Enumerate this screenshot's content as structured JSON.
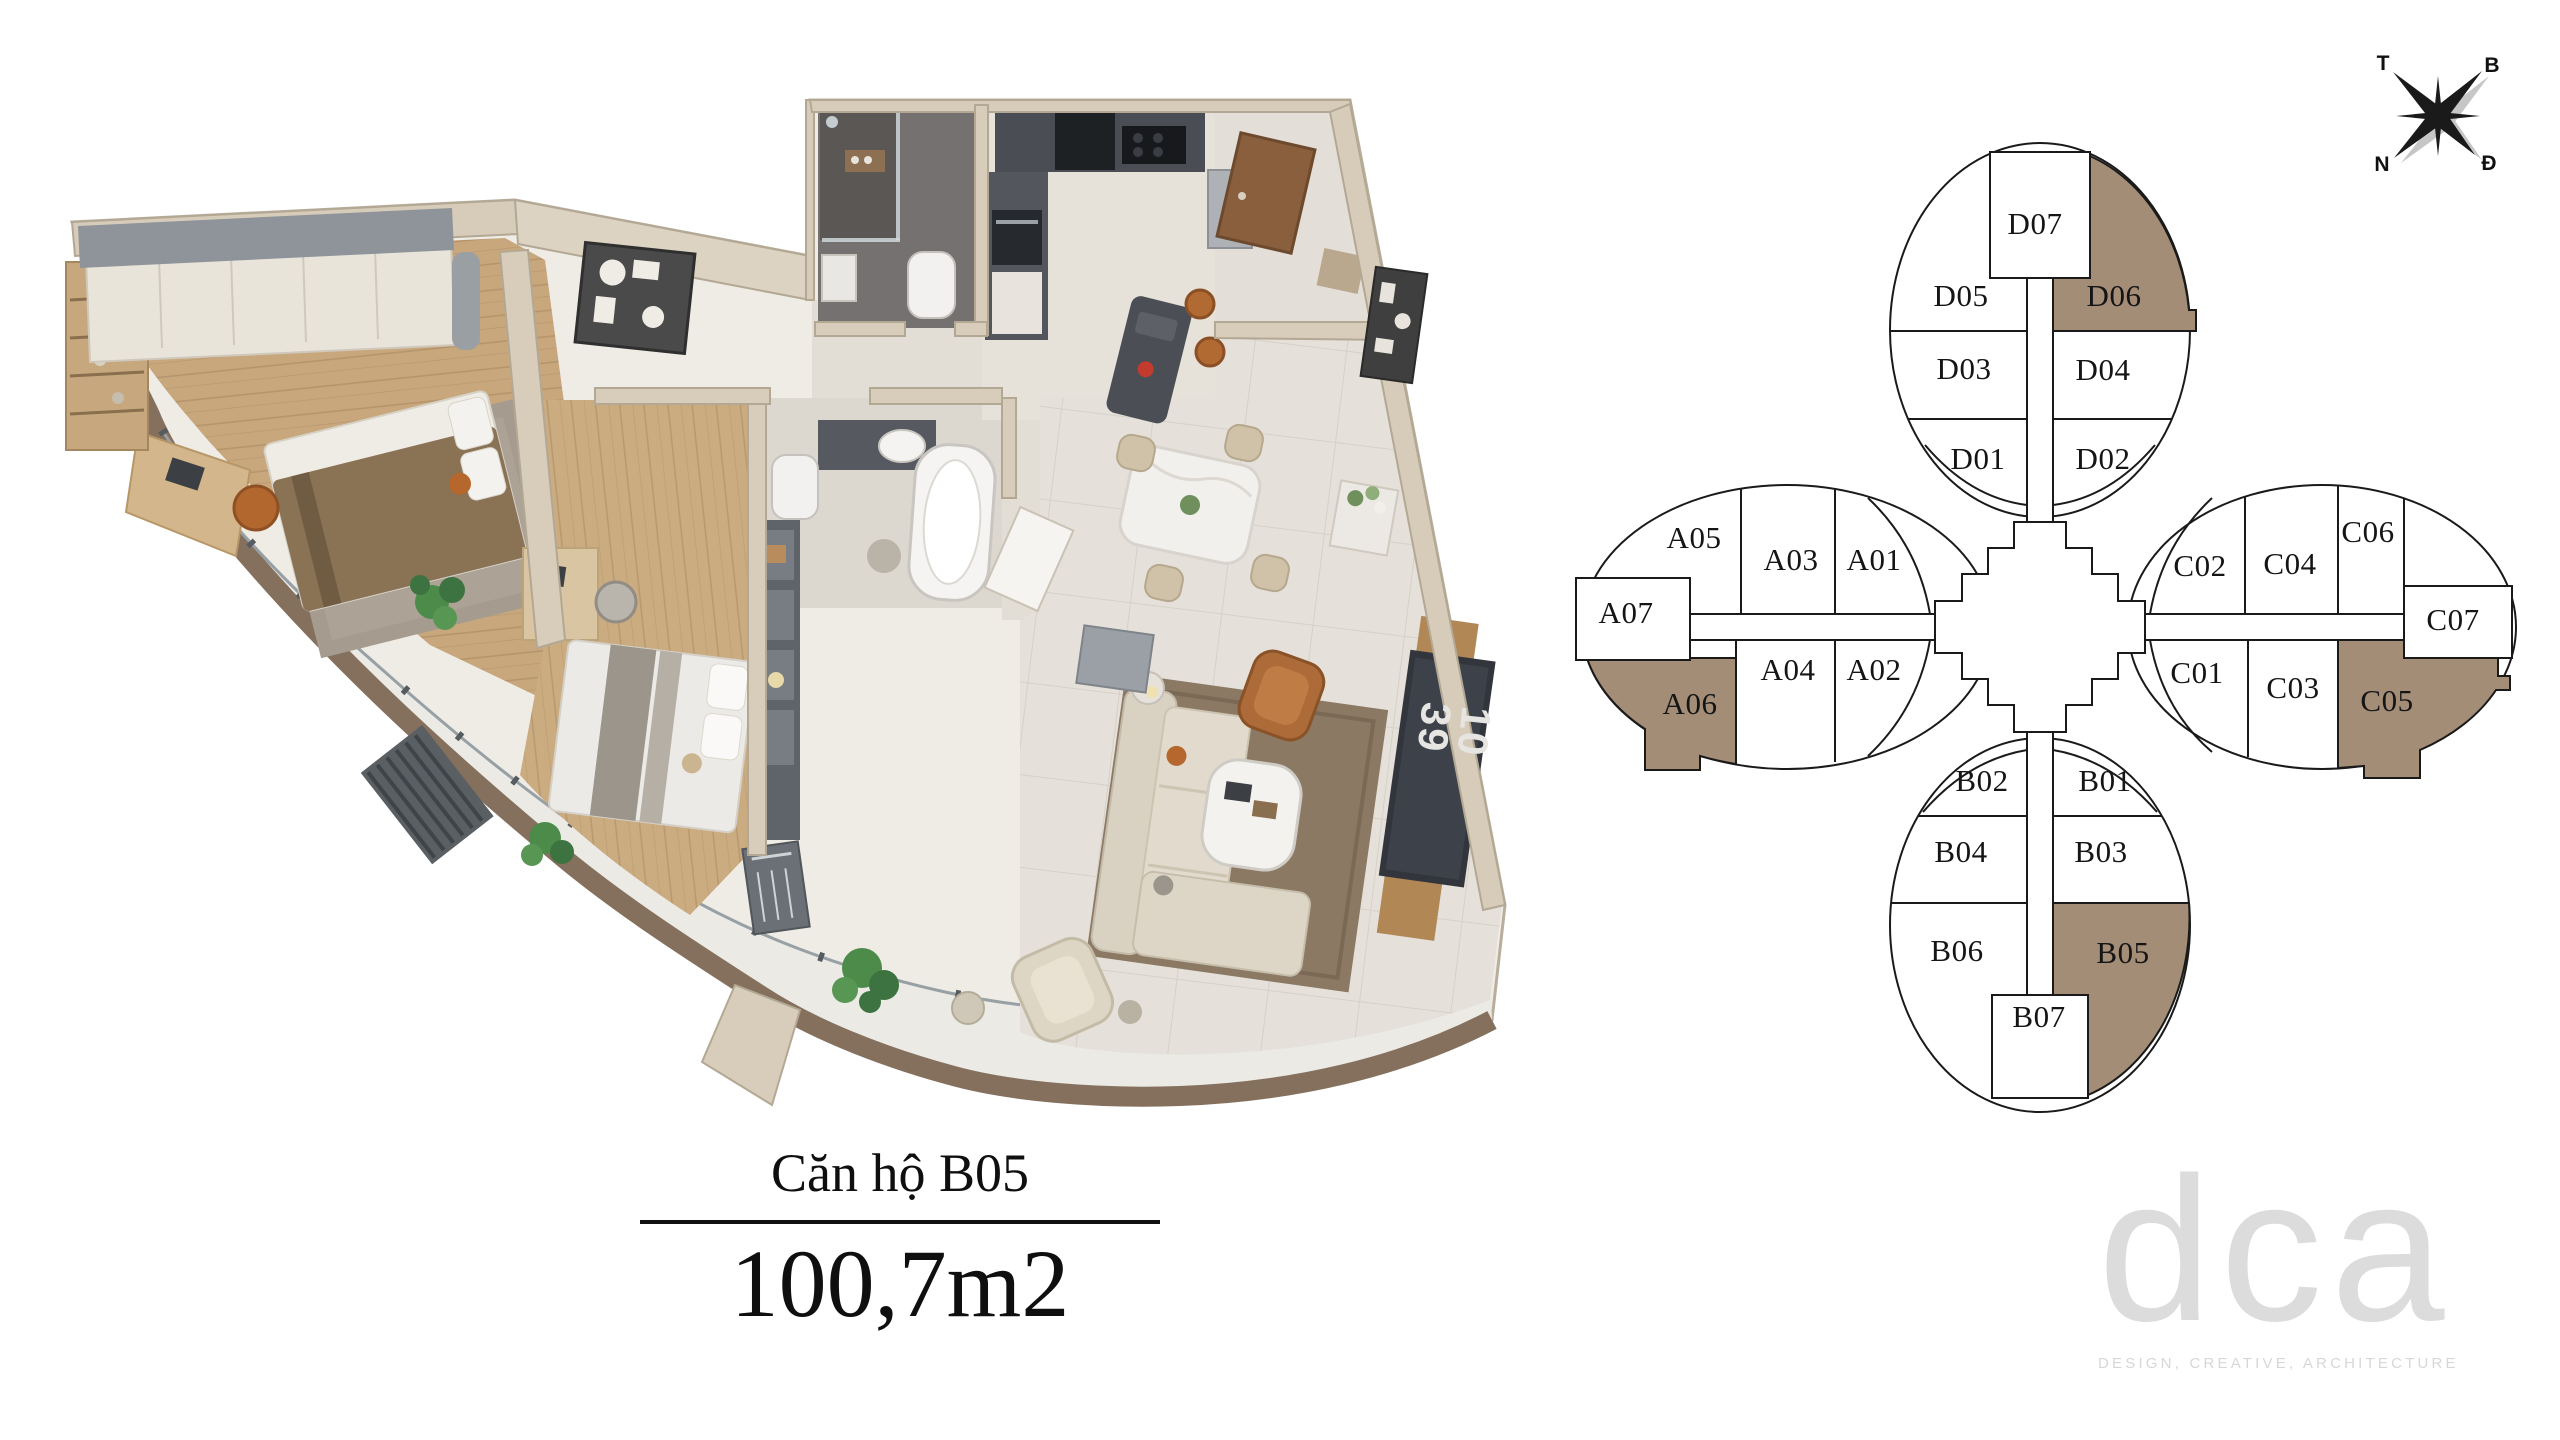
{
  "unit_card": {
    "name": "Căn hộ B05",
    "area": "100,7m2"
  },
  "compass": {
    "west": "T",
    "north": "B",
    "south": "N",
    "east": "Đ"
  },
  "floor_plan": {
    "tv_screen_text": "10 39"
  },
  "building_diagram": {
    "highlight_color": "#a38d77",
    "highlighted_units": [
      "D06",
      "A06",
      "C05",
      "B05"
    ],
    "units": [
      {
        "label": "D07"
      },
      {
        "label": "D05"
      },
      {
        "label": "D06"
      },
      {
        "label": "D03"
      },
      {
        "label": "D04"
      },
      {
        "label": "D01"
      },
      {
        "label": "D02"
      },
      {
        "label": "A05"
      },
      {
        "label": "A03"
      },
      {
        "label": "A01"
      },
      {
        "label": "A07"
      },
      {
        "label": "A04"
      },
      {
        "label": "A02"
      },
      {
        "label": "A06"
      },
      {
        "label": "C02"
      },
      {
        "label": "C04"
      },
      {
        "label": "C06"
      },
      {
        "label": "C07"
      },
      {
        "label": "C01"
      },
      {
        "label": "C03"
      },
      {
        "label": "C05"
      },
      {
        "label": "B02"
      },
      {
        "label": "B01"
      },
      {
        "label": "B04"
      },
      {
        "label": "B03"
      },
      {
        "label": "B06"
      },
      {
        "label": "B05"
      },
      {
        "label": "B07"
      }
    ]
  },
  "logo": {
    "wordmark": "dca",
    "tagline": "DESIGN, CREATIVE, ARCHITECTURE"
  }
}
